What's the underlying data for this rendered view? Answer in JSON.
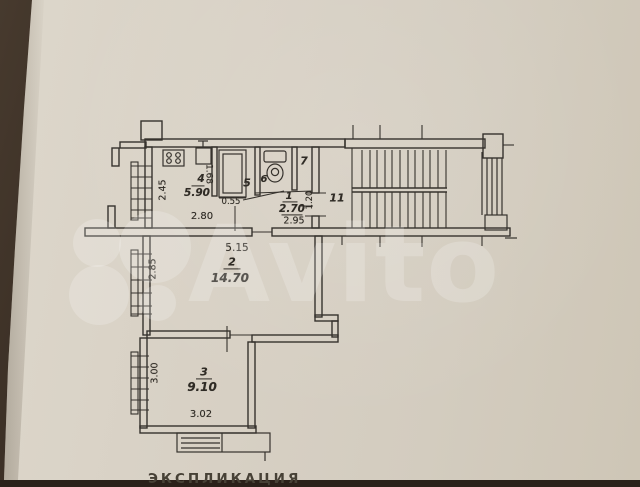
{
  "document": {
    "type": "apartment floor plan (photographed paper, technical passport drawing)",
    "caption_partial": "ЭКСПЛИКАЦИЯ"
  },
  "colors": {
    "paper": "#d6cfc2",
    "background": "#2e241c",
    "ink": "#36322d",
    "watermark": "rgba(255,255,255,0.20)"
  },
  "watermark": {
    "text": "Avito"
  },
  "caption": {
    "text": "ЭКСПЛИКАЦИЯ"
  },
  "rooms": [
    {
      "number": "4",
      "area": "5.90",
      "kind": "kitchen"
    },
    {
      "number": "5",
      "area": "",
      "kind": "bathroom-with-tub"
    },
    {
      "number": "6",
      "area": "",
      "kind": "wc"
    },
    {
      "number": "7",
      "area": "",
      "kind": "closet"
    },
    {
      "number": "1",
      "area": "2.70",
      "kind": "hall"
    },
    {
      "number": "11",
      "area": "",
      "kind": "stairwell"
    },
    {
      "number": "2",
      "area": "14.70",
      "kind": "living-room"
    },
    {
      "number": "3",
      "area": "9.10",
      "kind": "room"
    }
  ],
  "labels": {
    "dim_245": "2.45",
    "dim_168": "1.68",
    "room4_no": "4",
    "room4_area": "5.90",
    "dim_280": "2.80",
    "room5_no": "5",
    "dim_055": "0.55",
    "room6_no": "6",
    "room7_no": "7",
    "room1_no": "1",
    "room1_area": "2.70",
    "dim_295": "2.95",
    "dim_120": "1.20",
    "room11_no": "11",
    "dim_515": "5.15",
    "dim_285": "2.85",
    "room2_no": "2",
    "room2_area": "14.70",
    "dim_300": "3.00",
    "room3_no": "3",
    "room3_area": "9.10",
    "dim_302": "3.02"
  }
}
